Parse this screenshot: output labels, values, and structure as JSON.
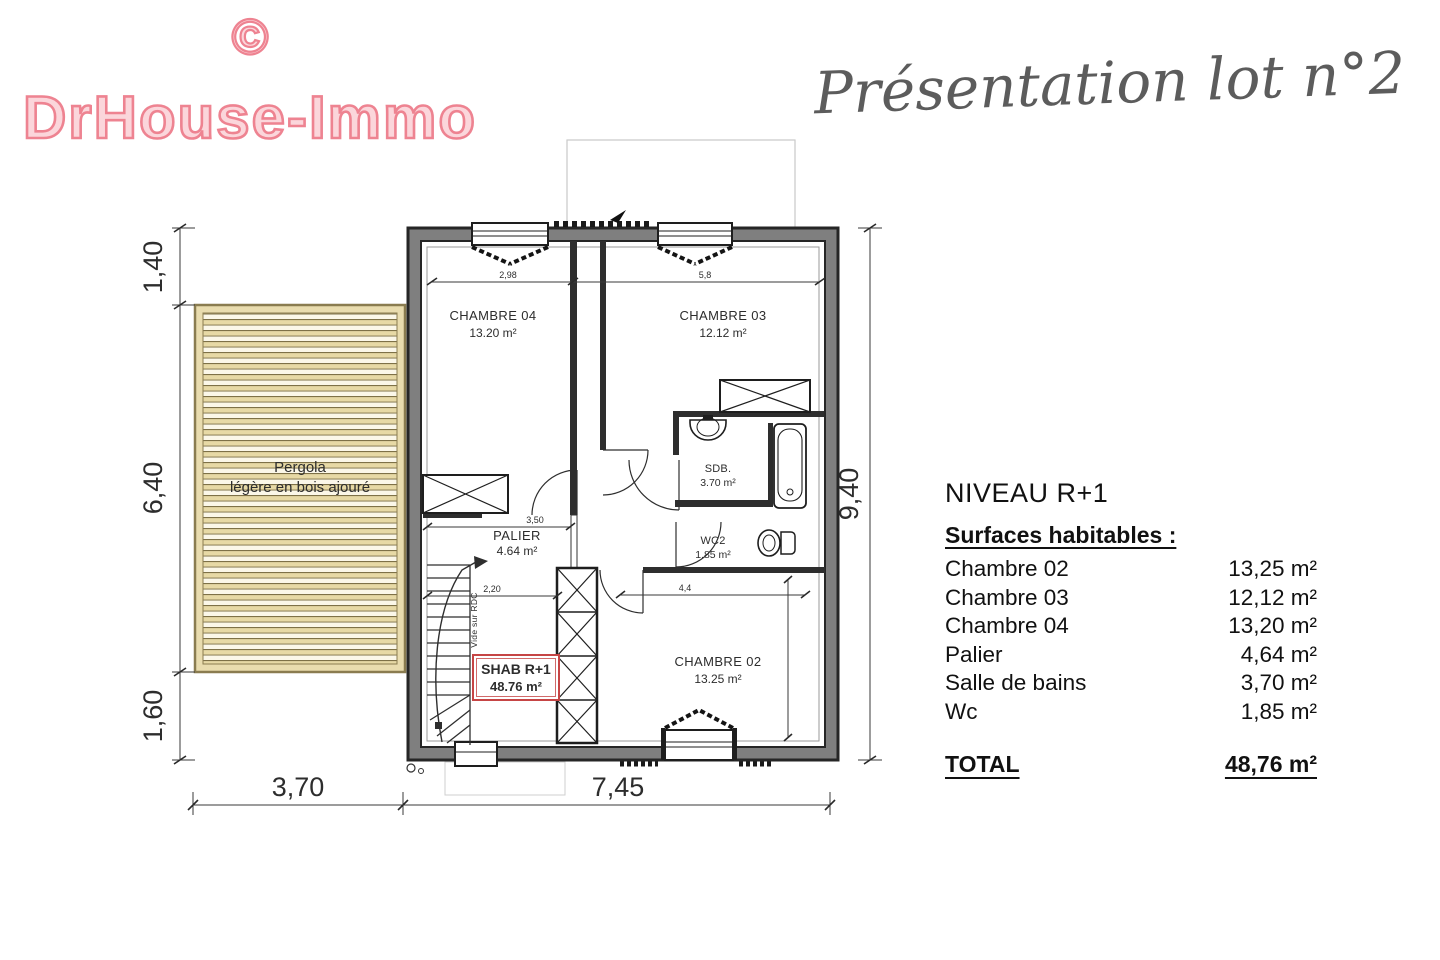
{
  "logo": {
    "symbol": "©",
    "text": "DrHouse-Immo"
  },
  "header": {
    "title": "Présentation lot n°2"
  },
  "plan": {
    "pergola_line1": "Pergola",
    "pergola_line2": "légère en bois ajouré",
    "rooms": {
      "ch04_name": "CHAMBRE 04",
      "ch04_area": "13.20 m²",
      "ch03_name": "CHAMBRE 03",
      "ch03_area": "12.12 m²",
      "sdb_name": "SDB.",
      "sdb_area": "3.70 m²",
      "wc2_name": "WC2",
      "wc2_area": "1.85 m²",
      "palier_name": "PALIER",
      "palier_area": "4.64 m²",
      "ch02_name": "CHAMBRE 02",
      "ch02_area": "13.25 m²"
    },
    "shab_label": "SHAB R+1",
    "shab_area": "48.76 m²",
    "void_label": "Vide sur RDC",
    "dims": {
      "left_top": "1,40",
      "left_mid": "6,40",
      "left_bottom": "1,60",
      "right": "9,40",
      "bottom_left": "3,70",
      "bottom_right": "7,45",
      "inner_top_left": "2,98",
      "inner_top_right": "5,8",
      "inner_palier": "3,50",
      "inner_shab": "2,20",
      "inner_ch02": "4,4"
    }
  },
  "table": {
    "title": "NIVEAU R+1",
    "subtitle": "Surfaces habitables :",
    "rows": [
      {
        "label": "Chambre 02",
        "value": "13,25 m²"
      },
      {
        "label": "Chambre 03",
        "value": "12,12 m²"
      },
      {
        "label": "Chambre 04",
        "value": "13,20 m²"
      },
      {
        "label": "Palier",
        "value": "4,64 m²"
      },
      {
        "label": "Salle de bains",
        "value": "3,70 m²"
      },
      {
        "label": "Wc",
        "value": "1,85 m²"
      }
    ],
    "total_label": "TOTAL",
    "total_value": "48,76 m²"
  },
  "colors": {
    "brand_pink": "#ee8391",
    "script_gray": "#5c5c5c",
    "plan_red": "#c64545",
    "pergola_fill": "#e9dcae"
  }
}
